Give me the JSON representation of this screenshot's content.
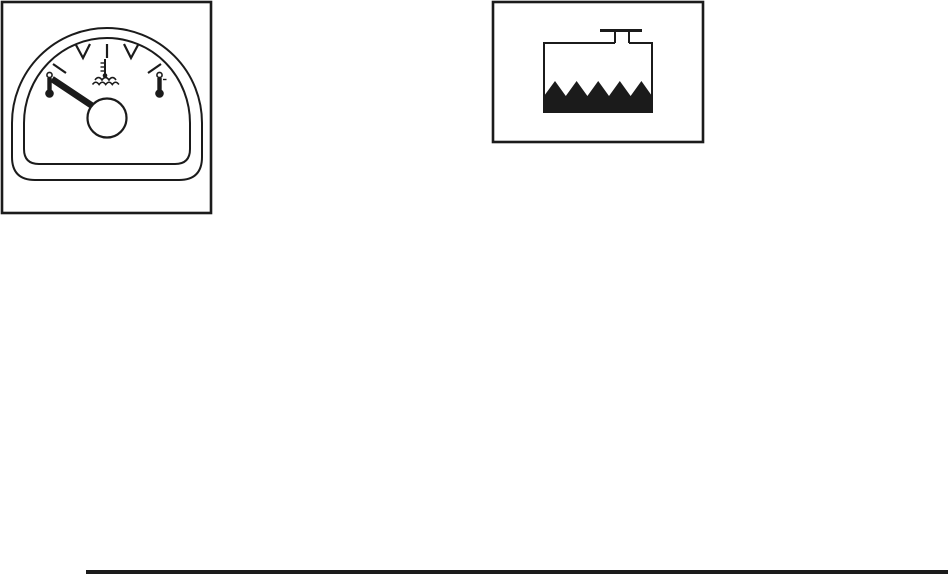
{
  "page": {
    "background": "#ffffff",
    "ink_color": "#1b1b1b"
  },
  "figures": {
    "temperature_gauge": {
      "name": "engine-coolant-temperature-gauge",
      "needle_position": "low-cold-end",
      "tick_marks": 5,
      "left_end_symbol": "cold-thermometer",
      "right_end_symbol": "hot-thermometer",
      "center_symbol": "coolant-temperature-thermometer-over-waves"
    },
    "coolant_level": {
      "name": "engine-coolant-level-tank",
      "cap": "filler-cap",
      "tank_state": "partially-filled-wavy-liquid",
      "liquid_color": "#1b1b1b"
    }
  },
  "footer": {
    "rule_color": "#1b1b1b"
  }
}
